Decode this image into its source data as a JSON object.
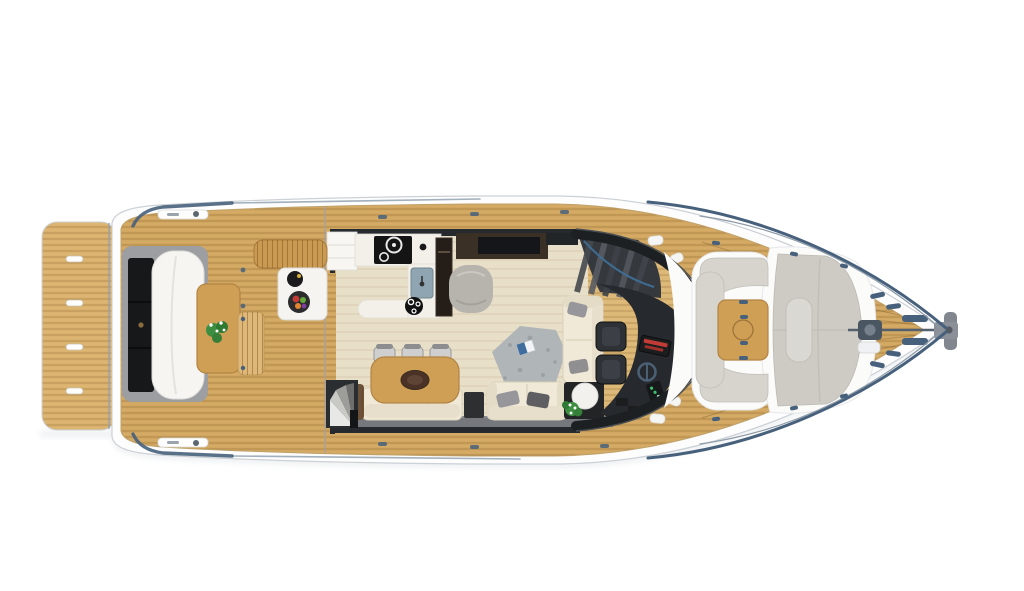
{
  "page": {
    "title": "",
    "background": "#ffffff",
    "type": "yacht-top-view-deck-plan-render"
  },
  "palette": {
    "bg": "#ffffff",
    "hull_white": "#fdfdfd",
    "hull_line": "#ccd1d6",
    "hull_shadow": "#e2e6e9",
    "teak": "#d1a660",
    "teak_light": "#dab26d",
    "teak_bench": "#ddb878",
    "floor": "#e8dfc9",
    "wood_table": "#cf9f55",
    "wood_edge": "#b28443",
    "cream": "#f0e9d7",
    "cream_shadow": "#d9d1ba",
    "gray_pillow": "#97969a",
    "dark_pillow": "#5f5e62",
    "rug": "#b0b5b8",
    "pouf": "#b7b4ae",
    "sunpad": "#cecbc5",
    "sunpad_light": "#dad8d3",
    "settee": "#d7d4ce",
    "white_base": "#fbfbfa",
    "counter": "#f3f0e9",
    "cooktop": "#141414",
    "dark_trim": "#26292d",
    "glass": "#1d2023",
    "charcoal": "#2e3236",
    "walnut": "#3a3026",
    "black_unit": "#17181a",
    "fridge": "#241d18",
    "sink": "#8fa6b2",
    "rail": "#47617c",
    "rail_light": "#8c99a6",
    "steel": "#8a8f98",
    "red_instr": "#c23b35",
    "green_led": "#38c06e",
    "plant": "#3e8e41",
    "flower": "#ffffff",
    "stair": "#35393e",
    "step_light": "#e8e8e6",
    "walkway": "#75797d",
    "wicker": "#6b5139",
    "lounger": "#c99a52",
    "bench_shell": "#9c9ea1",
    "cushion_white": "#f6f5f2"
  },
  "scene": {
    "vessel": "motor-yacht-main-deck-plan",
    "areas": [
      {
        "id": "swim-platform",
        "label": "Teak swim platform with four recessed handles"
      },
      {
        "id": "aft-deck",
        "label": "Aft cockpit with bench seat, wood table and transom bench"
      },
      {
        "id": "galley",
        "label": "L-shaped galley with cooktop, sink, round hob and tall fridge"
      },
      {
        "id": "dining",
        "label": "Dining table with oval centerpiece and three chairs"
      },
      {
        "id": "salon",
        "label": "Salon with cream sofas, gray pillows, area rug and side tables"
      },
      {
        "id": "helm",
        "label": "Helm station with two seats, dashboard, red display and wheel"
      },
      {
        "id": "bow",
        "label": "Bow lounge with U-settee, teak table, sun pad and anchor windlass"
      }
    ],
    "items": [
      "swim-platform",
      "platform-handles",
      "aft-bench-seat",
      "aft-bench-storage",
      "aft-bench-cushion",
      "aft-table",
      "aft-table-plant",
      "transom-bench",
      "lower-deck-spiral-stairs",
      "wicker-armrest",
      "galley-cabinet",
      "galley-counter",
      "cooktop",
      "galley-sink",
      "round-hob",
      "fridge-column",
      "wicker-lounger",
      "serving-table",
      "black-bowl",
      "fruit-plate",
      "gray-pouf",
      "tv-sideboard",
      "flybridge-stairs",
      "dining-table",
      "dining-chairs",
      "long-sofa",
      "dark-side-table",
      "loveseat",
      "l-sofa",
      "corner-table",
      "corner-table-plant",
      "area-rug",
      "magazine",
      "helm-seats",
      "helm-console",
      "red-display",
      "steering-wheel",
      "instrument-strip",
      "windshield-frame",
      "fenders",
      "walkway-step",
      "bow-console-cover",
      "bow-settee",
      "bow-table",
      "sun-pad",
      "sun-pad-backrest",
      "anchor-windlass",
      "anchor-chain",
      "bow-roller",
      "bow-rails",
      "deck-cleats",
      "side-decks",
      "bow-deck"
    ]
  }
}
